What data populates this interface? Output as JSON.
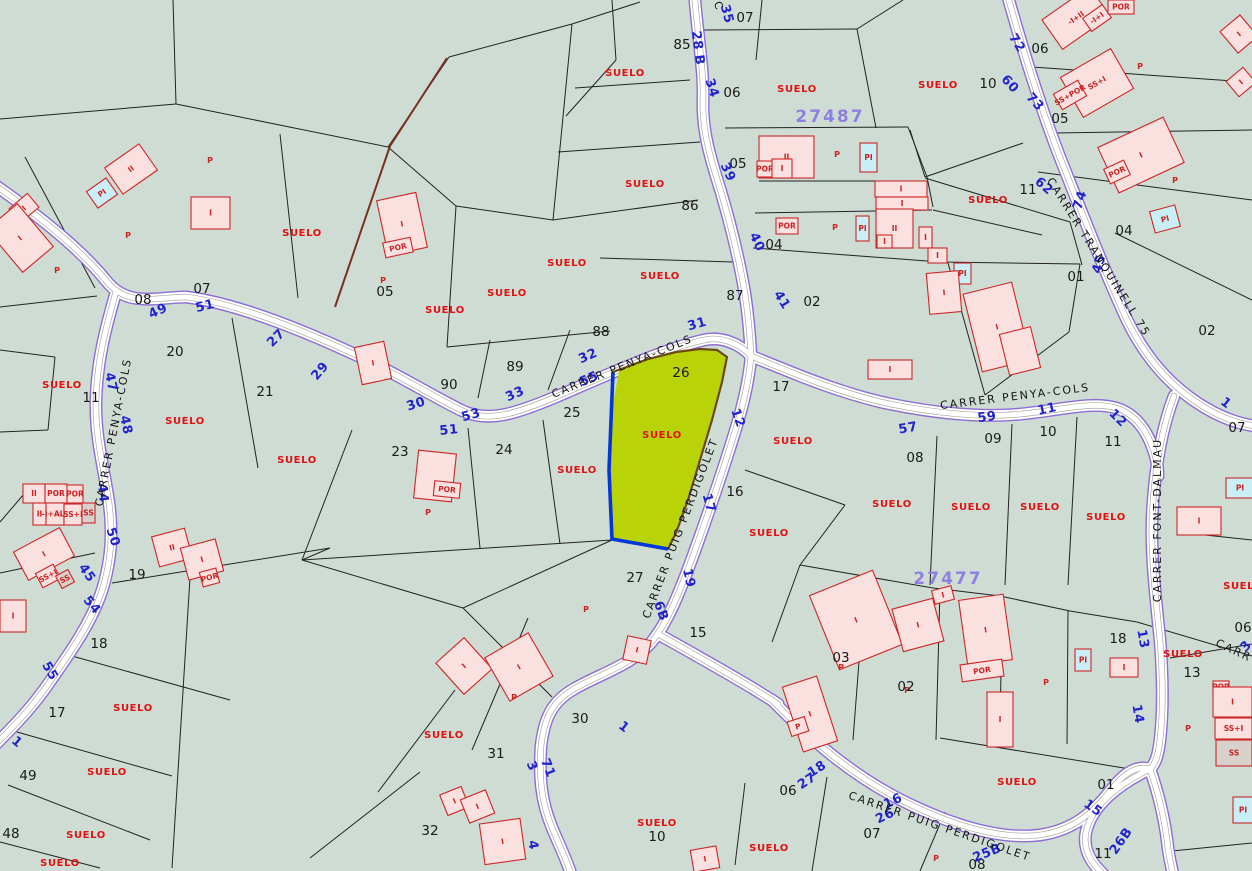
{
  "map": {
    "palette": {
      "background": "#cfdcd4",
      "road_fill": "#ffffff",
      "road_casing": "#8d6ed6",
      "road_inner_line": "#a8a8a8",
      "parcel_line": "#222222",
      "brown_boundary": "#7a3020",
      "highlight_fill": "#b8d408",
      "highlight_blue_edge": "#0636d8",
      "highlight_brown_edge": "#6b4a10",
      "building_fill": "#fbe0e0",
      "building_alt_fill": "#c9eef6",
      "building_grey_fill": "#d8d0ca",
      "building_stroke": "#cc2626",
      "street_number_color": "#2323cc",
      "suelo_color": "#e01212",
      "zone_color": "#8f7fe0"
    },
    "selected_parcel": {
      "number": "26",
      "land_label": "SUELO"
    },
    "zone_ids": [
      [
        "27487",
        830,
        116
      ],
      [
        "27477",
        948,
        578
      ]
    ],
    "street_names": [
      [
        "CARRER PENYA-COLS",
        113,
        432,
        -79
      ],
      [
        "CARRER PENYA-COLS",
        622,
        366,
        -22
      ],
      [
        "CARRER PENYA-COLS",
        1015,
        396,
        -7
      ],
      [
        "CARRER PUIG PERDIGOLET",
        680,
        528,
        -69
      ],
      [
        "CARRER PUIG PERDIGOLET",
        940,
        826,
        19
      ],
      [
        "CARRER FONT-DALMAU",
        1157,
        520,
        -90
      ],
      [
        "CARRER TRANQUINELL 75",
        1099,
        257,
        58
      ],
      [
        "CARR",
        1234,
        650,
        25
      ],
      [
        "C",
        719,
        6,
        70
      ]
    ],
    "street_numbers": [
      [
        "35",
        727,
        14,
        75
      ],
      [
        "28 B",
        698,
        48,
        83
      ],
      [
        "34",
        712,
        88,
        72
      ],
      [
        "39",
        728,
        172,
        65
      ],
      [
        "40",
        757,
        242,
        65
      ],
      [
        "41",
        782,
        300,
        58
      ],
      [
        "49",
        158,
        311,
        -25
      ],
      [
        "51",
        205,
        306,
        -14
      ],
      [
        "27",
        276,
        338,
        -45
      ],
      [
        "29",
        320,
        371,
        -50
      ],
      [
        "30",
        416,
        404,
        -18
      ],
      [
        "51",
        449,
        430,
        -6
      ],
      [
        "33",
        515,
        394,
        -24
      ],
      [
        "53",
        471,
        415,
        -16
      ],
      [
        "32",
        588,
        356,
        -24
      ],
      [
        "55",
        589,
        379,
        -24
      ],
      [
        "31",
        697,
        324,
        -16
      ],
      [
        "47",
        111,
        382,
        78
      ],
      [
        "48",
        126,
        425,
        78
      ],
      [
        "44",
        103,
        493,
        85
      ],
      [
        "50",
        113,
        537,
        72
      ],
      [
        "45",
        87,
        573,
        55
      ],
      [
        "54",
        92,
        605,
        50
      ],
      [
        "55",
        50,
        671,
        60
      ],
      [
        "1",
        17,
        742,
        40
      ],
      [
        "57",
        908,
        428,
        -10
      ],
      [
        "59",
        987,
        417,
        -8
      ],
      [
        "11",
        1047,
        409,
        -12
      ],
      [
        "12",
        1118,
        418,
        45
      ],
      [
        "12",
        738,
        418,
        70
      ],
      [
        "17",
        709,
        503,
        74
      ],
      [
        "19",
        689,
        578,
        78
      ],
      [
        "6B",
        661,
        611,
        70
      ],
      [
        "1",
        624,
        727,
        38
      ],
      [
        "3",
        532,
        766,
        68
      ],
      [
        "71",
        548,
        768,
        68
      ],
      [
        "4",
        533,
        845,
        80
      ],
      [
        "18",
        817,
        769,
        -33
      ],
      [
        "27",
        807,
        781,
        -33
      ],
      [
        "16",
        893,
        801,
        -26
      ],
      [
        "26",
        885,
        816,
        -26
      ],
      [
        "25B",
        987,
        853,
        -22
      ],
      [
        "15",
        1093,
        808,
        35
      ],
      [
        "26B",
        1121,
        841,
        -55
      ],
      [
        "13",
        1143,
        639,
        80
      ],
      [
        "14",
        1138,
        714,
        80
      ],
      [
        "1",
        1226,
        403,
        38
      ],
      [
        "3",
        1246,
        646,
        -50
      ],
      [
        "72",
        1017,
        43,
        58
      ],
      [
        "60",
        1010,
        84,
        48
      ],
      [
        "73",
        1035,
        102,
        48
      ],
      [
        "62",
        1044,
        186,
        40
      ],
      [
        "74",
        1080,
        200,
        -72
      ],
      [
        "45",
        1099,
        264,
        -72
      ]
    ],
    "parcel_numbers": [
      [
        "07",
        745,
        17
      ],
      [
        "85",
        682,
        44
      ],
      [
        "06",
        732,
        92
      ],
      [
        "05",
        738,
        163
      ],
      [
        "86",
        690,
        205
      ],
      [
        "04",
        774,
        244
      ],
      [
        "87",
        735,
        295
      ],
      [
        "88",
        601,
        331
      ],
      [
        "89",
        515,
        366
      ],
      [
        "90",
        449,
        384
      ],
      [
        "26",
        681,
        372
      ],
      [
        "17",
        781,
        386
      ],
      [
        "25",
        572,
        412
      ],
      [
        "24",
        504,
        449
      ],
      [
        "23",
        400,
        451
      ],
      [
        "16",
        735,
        491
      ],
      [
        "27",
        635,
        577
      ],
      [
        "20",
        175,
        351
      ],
      [
        "21",
        265,
        391
      ],
      [
        "11",
        91,
        397
      ],
      [
        "08",
        143,
        299
      ],
      [
        "07",
        202,
        288
      ],
      [
        "19",
        137,
        574
      ],
      [
        "18",
        99,
        643
      ],
      [
        "17",
        57,
        712
      ],
      [
        "49",
        28,
        775
      ],
      [
        "48",
        11,
        833
      ],
      [
        "30",
        580,
        718
      ],
      [
        "31",
        496,
        753
      ],
      [
        "32",
        430,
        830
      ],
      [
        "15",
        698,
        632
      ],
      [
        "10",
        657,
        836
      ],
      [
        "06",
        788,
        790
      ],
      [
        "07",
        872,
        833
      ],
      [
        "02",
        906,
        686
      ],
      [
        "03",
        841,
        657
      ],
      [
        "01",
        1106,
        784
      ],
      [
        "11",
        1103,
        853
      ],
      [
        "08",
        977,
        864
      ],
      [
        "18",
        1118,
        638
      ],
      [
        "13",
        1192,
        672
      ],
      [
        "06",
        1243,
        627
      ],
      [
        "07",
        1237,
        427
      ],
      [
        "02",
        1207,
        330
      ],
      [
        "01",
        1076,
        276
      ],
      [
        "04",
        1124,
        230
      ],
      [
        "11",
        1028,
        189
      ],
      [
        "05",
        1060,
        118
      ],
      [
        "06",
        1040,
        48
      ],
      [
        "10",
        988,
        83
      ],
      [
        "11",
        1113,
        441
      ],
      [
        "10",
        1048,
        431
      ],
      [
        "09",
        993,
        438
      ],
      [
        "08",
        915,
        457
      ],
      [
        "02",
        812,
        301
      ],
      [
        "05",
        385,
        291
      ]
    ],
    "suelo_text": "SUELO",
    "suelo_labels": [
      [
        625,
        76
      ],
      [
        797,
        92
      ],
      [
        938,
        88
      ],
      [
        645,
        187
      ],
      [
        988,
        203
      ],
      [
        660,
        279
      ],
      [
        302,
        236
      ],
      [
        445,
        313
      ],
      [
        507,
        296
      ],
      [
        567,
        266
      ],
      [
        62,
        388
      ],
      [
        185,
        424
      ],
      [
        297,
        463
      ],
      [
        577,
        473
      ],
      [
        662,
        438
      ],
      [
        793,
        444
      ],
      [
        769,
        536
      ],
      [
        892,
        507
      ],
      [
        971,
        510
      ],
      [
        1040,
        510
      ],
      [
        1106,
        520
      ],
      [
        1243,
        589
      ],
      [
        1183,
        657
      ],
      [
        133,
        711
      ],
      [
        107,
        775
      ],
      [
        86,
        838
      ],
      [
        60,
        866
      ],
      [
        444,
        738
      ],
      [
        657,
        826
      ],
      [
        1017,
        785
      ],
      [
        769,
        851
      ]
    ],
    "p_marks": [
      [
        210,
        163
      ],
      [
        128,
        238
      ],
      [
        57,
        273
      ],
      [
        383,
        283
      ],
      [
        428,
        515
      ],
      [
        514,
        700
      ],
      [
        586,
        612
      ],
      [
        837,
        157
      ],
      [
        835,
        230
      ],
      [
        1140,
        69
      ],
      [
        1175,
        183
      ],
      [
        841,
        670
      ],
      [
        907,
        693
      ],
      [
        1046,
        685
      ],
      [
        1188,
        731
      ],
      [
        936,
        861
      ]
    ],
    "buildings": [
      [
        110,
        153,
        42,
        32,
        -35,
        "II",
        0
      ],
      [
        90,
        183,
        24,
        20,
        -35,
        "PI",
        1
      ],
      [
        12,
        199,
        24,
        18,
        -40,
        "I",
        0
      ],
      [
        0,
        210,
        40,
        56,
        -40,
        "I",
        0
      ],
      [
        191,
        197,
        39,
        32,
        0,
        "I",
        0
      ],
      [
        382,
        196,
        40,
        56,
        -12,
        "I",
        0
      ],
      [
        384,
        240,
        28,
        15,
        -12,
        "POR",
        0
      ],
      [
        358,
        344,
        30,
        38,
        -12,
        "I",
        0
      ],
      [
        416,
        452,
        38,
        48,
        6,
        "",
        0
      ],
      [
        434,
        482,
        26,
        15,
        6,
        "POR",
        0
      ],
      [
        23,
        484,
        22,
        19,
        0,
        "II",
        0
      ],
      [
        45,
        484,
        22,
        19,
        0,
        "POR",
        0
      ],
      [
        67,
        485,
        16,
        18,
        0,
        "POR",
        0
      ],
      [
        33,
        503,
        13,
        22,
        0,
        "II",
        0
      ],
      [
        46,
        503,
        18,
        22,
        0,
        "-I+ALT",
        0
      ],
      [
        64,
        504,
        18,
        21,
        0,
        "SS+I",
        0
      ],
      [
        82,
        503,
        13,
        20,
        0,
        "SS",
        2
      ],
      [
        18,
        538,
        52,
        32,
        -28,
        "I",
        0
      ],
      [
        38,
        568,
        20,
        16,
        -28,
        "SS+I",
        0
      ],
      [
        58,
        572,
        14,
        14,
        -28,
        "SS",
        2
      ],
      [
        0,
        600,
        26,
        32,
        0,
        "I",
        0
      ],
      [
        155,
        532,
        34,
        31,
        -15,
        "II",
        0
      ],
      [
        184,
        543,
        36,
        33,
        -15,
        "I",
        0
      ],
      [
        201,
        570,
        17,
        15,
        -15,
        "POR",
        0
      ],
      [
        445,
        645,
        38,
        42,
        -42,
        "I",
        0
      ],
      [
        494,
        642,
        50,
        50,
        -30,
        "I",
        0
      ],
      [
        443,
        790,
        23,
        22,
        -22,
        "I",
        0
      ],
      [
        464,
        794,
        27,
        25,
        -22,
        "I",
        0
      ],
      [
        482,
        821,
        41,
        41,
        -8,
        "I",
        0
      ],
      [
        625,
        638,
        24,
        24,
        12,
        "I",
        0
      ],
      [
        692,
        848,
        26,
        22,
        -10,
        "I",
        0
      ],
      [
        792,
        680,
        36,
        68,
        -18,
        "I",
        0
      ],
      [
        789,
        719,
        18,
        15,
        -18,
        "P",
        0
      ],
      [
        987,
        692,
        26,
        55,
        0,
        "I",
        0
      ],
      [
        822,
        580,
        68,
        80,
        -22,
        "I",
        0
      ],
      [
        897,
        603,
        42,
        44,
        -15,
        "I",
        0
      ],
      [
        933,
        588,
        20,
        14,
        -15,
        "I",
        0
      ],
      [
        963,
        597,
        45,
        66,
        -8,
        "I",
        0
      ],
      [
        961,
        662,
        42,
        17,
        -8,
        "POR",
        0
      ],
      [
        1075,
        649,
        16,
        22,
        0,
        "PI",
        1
      ],
      [
        1110,
        658,
        28,
        19,
        0,
        "I",
        0
      ],
      [
        759,
        136,
        55,
        42,
        0,
        "II",
        0
      ],
      [
        757,
        161,
        16,
        16,
        0,
        "POR",
        0
      ],
      [
        772,
        159,
        20,
        19,
        0,
        "I",
        0
      ],
      [
        860,
        143,
        17,
        29,
        0,
        "PI",
        1
      ],
      [
        875,
        181,
        52,
        16,
        0,
        "I",
        0
      ],
      [
        876,
        197,
        52,
        13,
        0,
        "I",
        0
      ],
      [
        876,
        209,
        37,
        39,
        0,
        "II",
        0
      ],
      [
        877,
        235,
        15,
        13,
        0,
        "I",
        0
      ],
      [
        919,
        227,
        13,
        21,
        0,
        "I",
        0
      ],
      [
        856,
        216,
        13,
        25,
        0,
        "PI",
        1
      ],
      [
        776,
        218,
        22,
        16,
        0,
        "POR",
        0
      ],
      [
        928,
        248,
        19,
        15,
        0,
        "I",
        0
      ],
      [
        954,
        263,
        17,
        21,
        0,
        "PI",
        1
      ],
      [
        928,
        272,
        32,
        41,
        -5,
        "I",
        0
      ],
      [
        972,
        287,
        50,
        80,
        -14,
        "I",
        0
      ],
      [
        1004,
        330,
        32,
        42,
        -14,
        "",
        0
      ],
      [
        868,
        360,
        44,
        19,
        0,
        "I",
        0
      ],
      [
        1047,
        0,
        58,
        36,
        -35,
        "-I+II",
        0
      ],
      [
        1085,
        10,
        24,
        16,
        -35,
        "-I+I",
        0
      ],
      [
        1108,
        0,
        26,
        14,
        0,
        "POR",
        0
      ],
      [
        1068,
        60,
        58,
        46,
        -30,
        "SS+I",
        0
      ],
      [
        1056,
        86,
        28,
        18,
        -30,
        "SS+POR",
        0
      ],
      [
        1105,
        130,
        72,
        50,
        -25,
        "I",
        0
      ],
      [
        1106,
        164,
        22,
        16,
        -25,
        "POR",
        0
      ],
      [
        1226,
        20,
        26,
        28,
        -40,
        "I",
        0
      ],
      [
        1230,
        72,
        22,
        20,
        -40,
        "I",
        0
      ],
      [
        1152,
        208,
        26,
        22,
        -15,
        "PI",
        1
      ],
      [
        1226,
        478,
        28,
        20,
        0,
        "PI",
        1
      ],
      [
        1177,
        507,
        44,
        28,
        0,
        "I",
        0
      ],
      [
        1213,
        681,
        16,
        12,
        0,
        "POR",
        0
      ],
      [
        1213,
        687,
        39,
        30,
        0,
        "I",
        0
      ],
      [
        1215,
        718,
        37,
        21,
        0,
        "SS+I",
        0
      ],
      [
        1216,
        740,
        36,
        26,
        0,
        "SS",
        2
      ],
      [
        1233,
        797,
        20,
        26,
        0,
        "PI",
        1
      ]
    ]
  }
}
